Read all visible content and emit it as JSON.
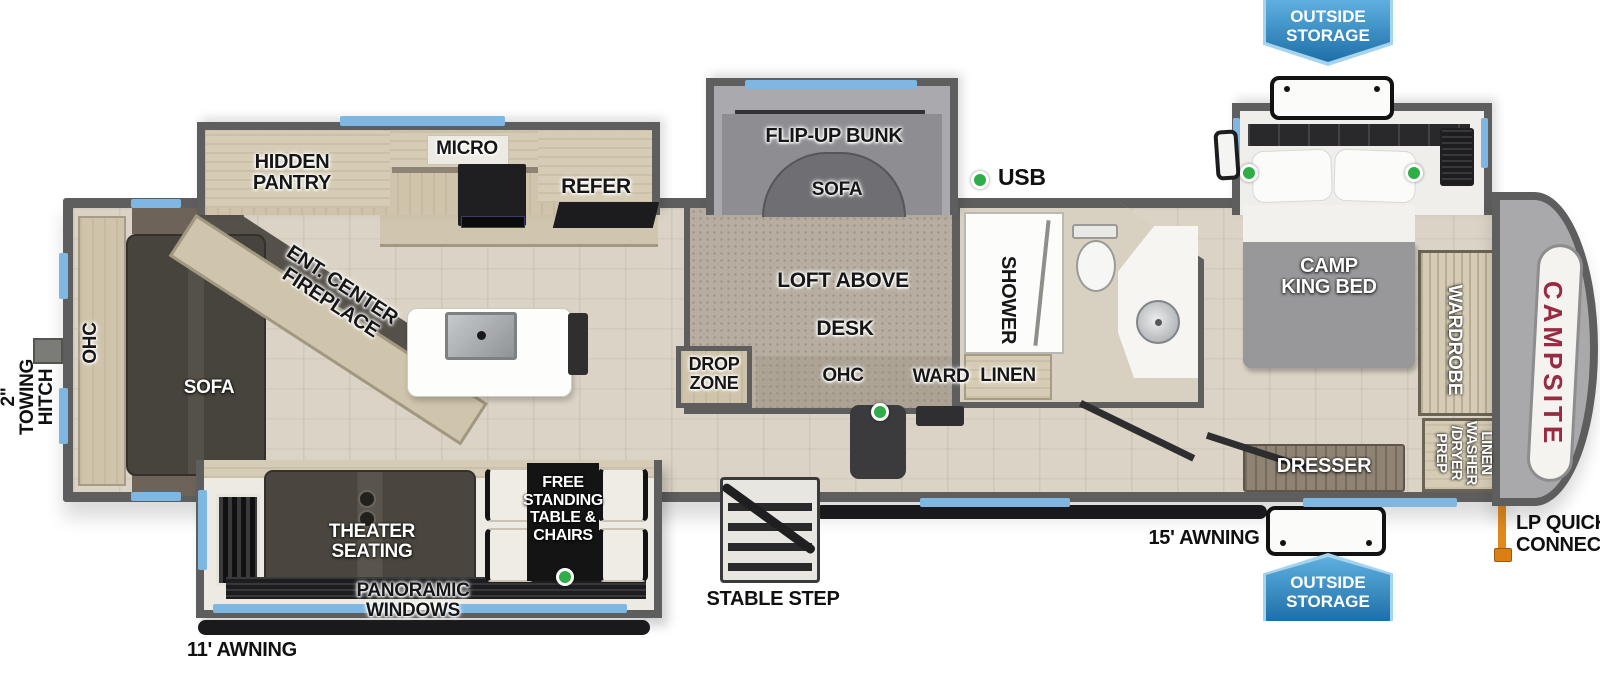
{
  "title": "Fifth wheel RV floorplan",
  "labels": {
    "outside_storage_top": "OUTSIDE\nSTORAGE",
    "outside_storage_bottom": "OUTSIDE\nSTORAGE",
    "hidden_pantry": "HIDDEN\nPANTRY",
    "micro": "MICRO",
    "refer": "REFER",
    "ent_center_fireplace": "ENT. CENTER\nFIREPLACE",
    "ohc_rear": "OHC",
    "rear_sofa": "SOFA",
    "towing_hitch": "2\"\nTOWING\nHITCH",
    "flip_up_bunk": "FLIP-UP BUNK",
    "bunk_sofa": "SOFA",
    "usb": "USB",
    "loft_above": "LOFT ABOVE",
    "desk": "DESK",
    "drop_zone": "DROP\nZONE",
    "ohc_desk": "OHC",
    "ward": "WARD",
    "shower": "SHOWER",
    "linen": "LINEN",
    "camp_king_bed": "CAMP\nKING BED",
    "wardrobe": "WARDROBE",
    "linen_washer_dryer_prep": "LINEN\nWASHER\n/DRYER\nPREP",
    "dresser": "DRESSER",
    "theater_seating": "THEATER SEATING",
    "free_standing_table_chairs": "FREE\nSTANDING\nTABLE &\nCHAIRS",
    "panoramic_windows": "PANORAMIC WINDOWS",
    "stable_step": "STABLE STEP",
    "awning_11": "11' AWNING",
    "awning_15": "15' AWNING",
    "lp_quick_connect": "LP QUICK\nCONNECT",
    "brand": "CAMPSITE"
  },
  "colors": {
    "wall": "#5e5e5e",
    "window_accent": "#7fb7e3",
    "banner_blue_top": "#5fb0df",
    "banner_blue_bottom": "#1d6fa8",
    "usb_green": "#2fae47",
    "brand_red": "#982b43",
    "lp_orange": "#e08a1e",
    "floor_wood": "#dbd4c6",
    "carpet": "#b7aea1",
    "cabinet_wood": "#d6ccb5",
    "dark_furniture": "#47433d"
  }
}
